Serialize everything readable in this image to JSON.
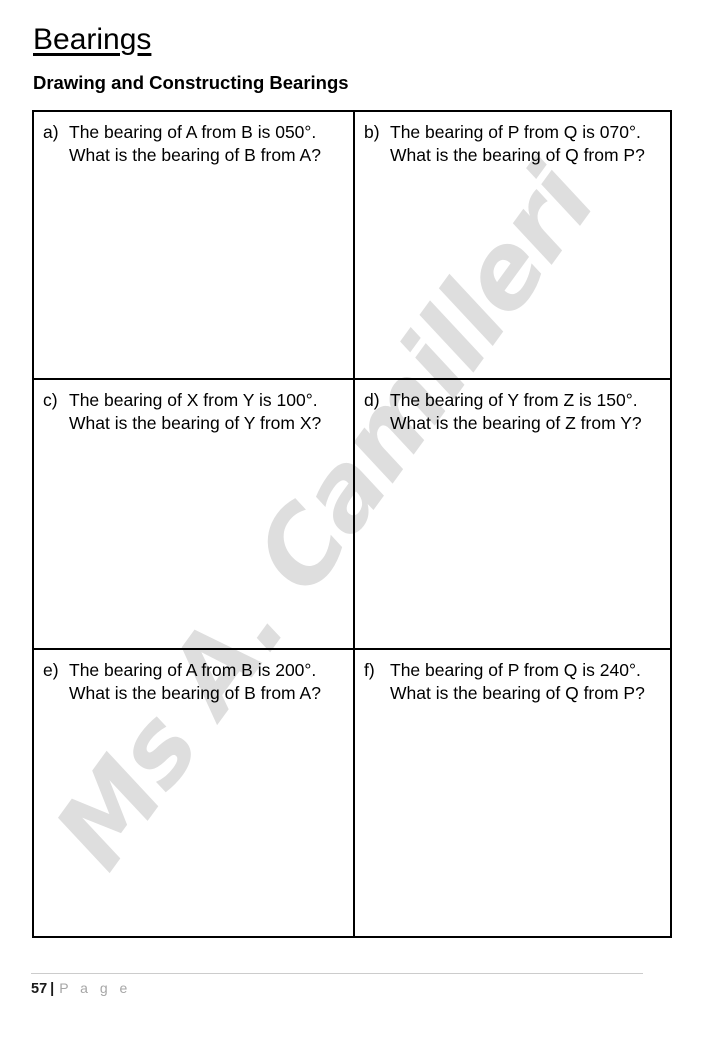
{
  "page": {
    "title": "Bearings",
    "subtitle": "Drawing and Constructing Bearings"
  },
  "watermark": {
    "text": "Ms A. Camilleri",
    "color": "#dedede"
  },
  "questions": [
    {
      "label": "a)",
      "line1": "The bearing of A from B is 050°.",
      "line2": "What is the bearing of B from A?"
    },
    {
      "label": "b)",
      "line1": "The bearing of P from Q is 070°.",
      "line2": "What is the bearing of Q from P?"
    },
    {
      "label": "c)",
      "line1": "The bearing of X from Y is 100°.",
      "line2": "What is the bearing of Y from X?"
    },
    {
      "label": "d)",
      "line1": "The bearing of Y from Z is 150°.",
      "line2": "What is the bearing of Z from Y?"
    },
    {
      "label": "e)",
      "line1": "The bearing of A from B is 200°.",
      "line2": "What is the bearing of B from A?"
    },
    {
      "label": "f)",
      "line1": "The bearing of P from Q is 240°.",
      "line2": "What is the bearing of Q from P?"
    }
  ],
  "footer": {
    "page_number": "57",
    "separator": "|",
    "label": "P a g e"
  }
}
